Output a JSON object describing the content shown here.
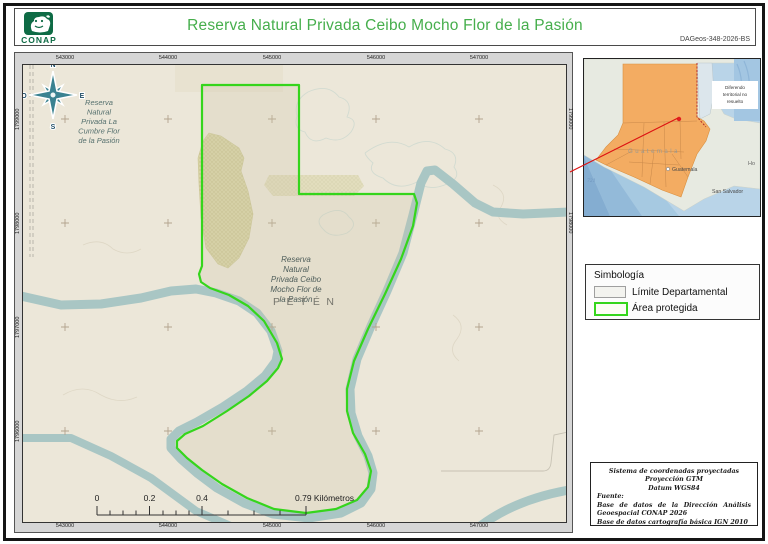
{
  "header": {
    "title": "Reserva Natural Privada Ceibo Mocho Flor de la Pasión",
    "doc_id": "DAGeos-348-2026-BS",
    "logo_text": "CONAP"
  },
  "map": {
    "x_labels": [
      "543000",
      "544000",
      "545000",
      "546000",
      "547000"
    ],
    "y_labels": [
      "1799000",
      "1798000",
      "1797000",
      "1796000"
    ],
    "compass": {
      "n": "N",
      "e": "E",
      "s": "S",
      "o": "O"
    },
    "labels": {
      "nw_reserve": [
        "Reserva",
        "Natural",
        "Privada La",
        "Cumbre Flor",
        "de la Pasión"
      ],
      "center_reserve": [
        "Reserva",
        "Natural",
        "Privada Ceibo",
        "Mocho Flor de",
        "la Pasión"
      ],
      "department": "PETÉN"
    },
    "scalebar": {
      "t0": "0",
      "t1": "0.2",
      "t2": "0.4",
      "t3": "0.79 Kilómetros"
    }
  },
  "inset": {
    "country_label": "Guatemala",
    "city_label": "Guatemala",
    "neighbor_label": "San Salvador",
    "honduras_label": "Ho",
    "depth_label": "721",
    "note_lines": [
      "Diferendo",
      "territorial no",
      "resuelto"
    ]
  },
  "legend": {
    "title": "Simbología",
    "items": [
      {
        "label": "Límite Departamental"
      },
      {
        "label": "Área protegida"
      }
    ]
  },
  "credits": {
    "center_lines": [
      "Sistema de coordenadas proyectadas",
      "Proyección GTM",
      "Datum WGS84"
    ],
    "source_title": "Fuente:",
    "source_lines": [
      "Base de datos de la Dirección Análisis Geoespacial CONAP 2026",
      "Base de datos cartografía básica IGN 2010"
    ]
  },
  "colors": {
    "title_green": "#46ae4c",
    "logo_green": "#0e6b45",
    "protected_area_green": "#35d51c",
    "river_teal": "#a9c6c4",
    "map_background": "#ece7d9",
    "guatemala_orange": "#f3ac62",
    "sea_blue": "#b9d4e8",
    "red_link": "#dd1111"
  }
}
